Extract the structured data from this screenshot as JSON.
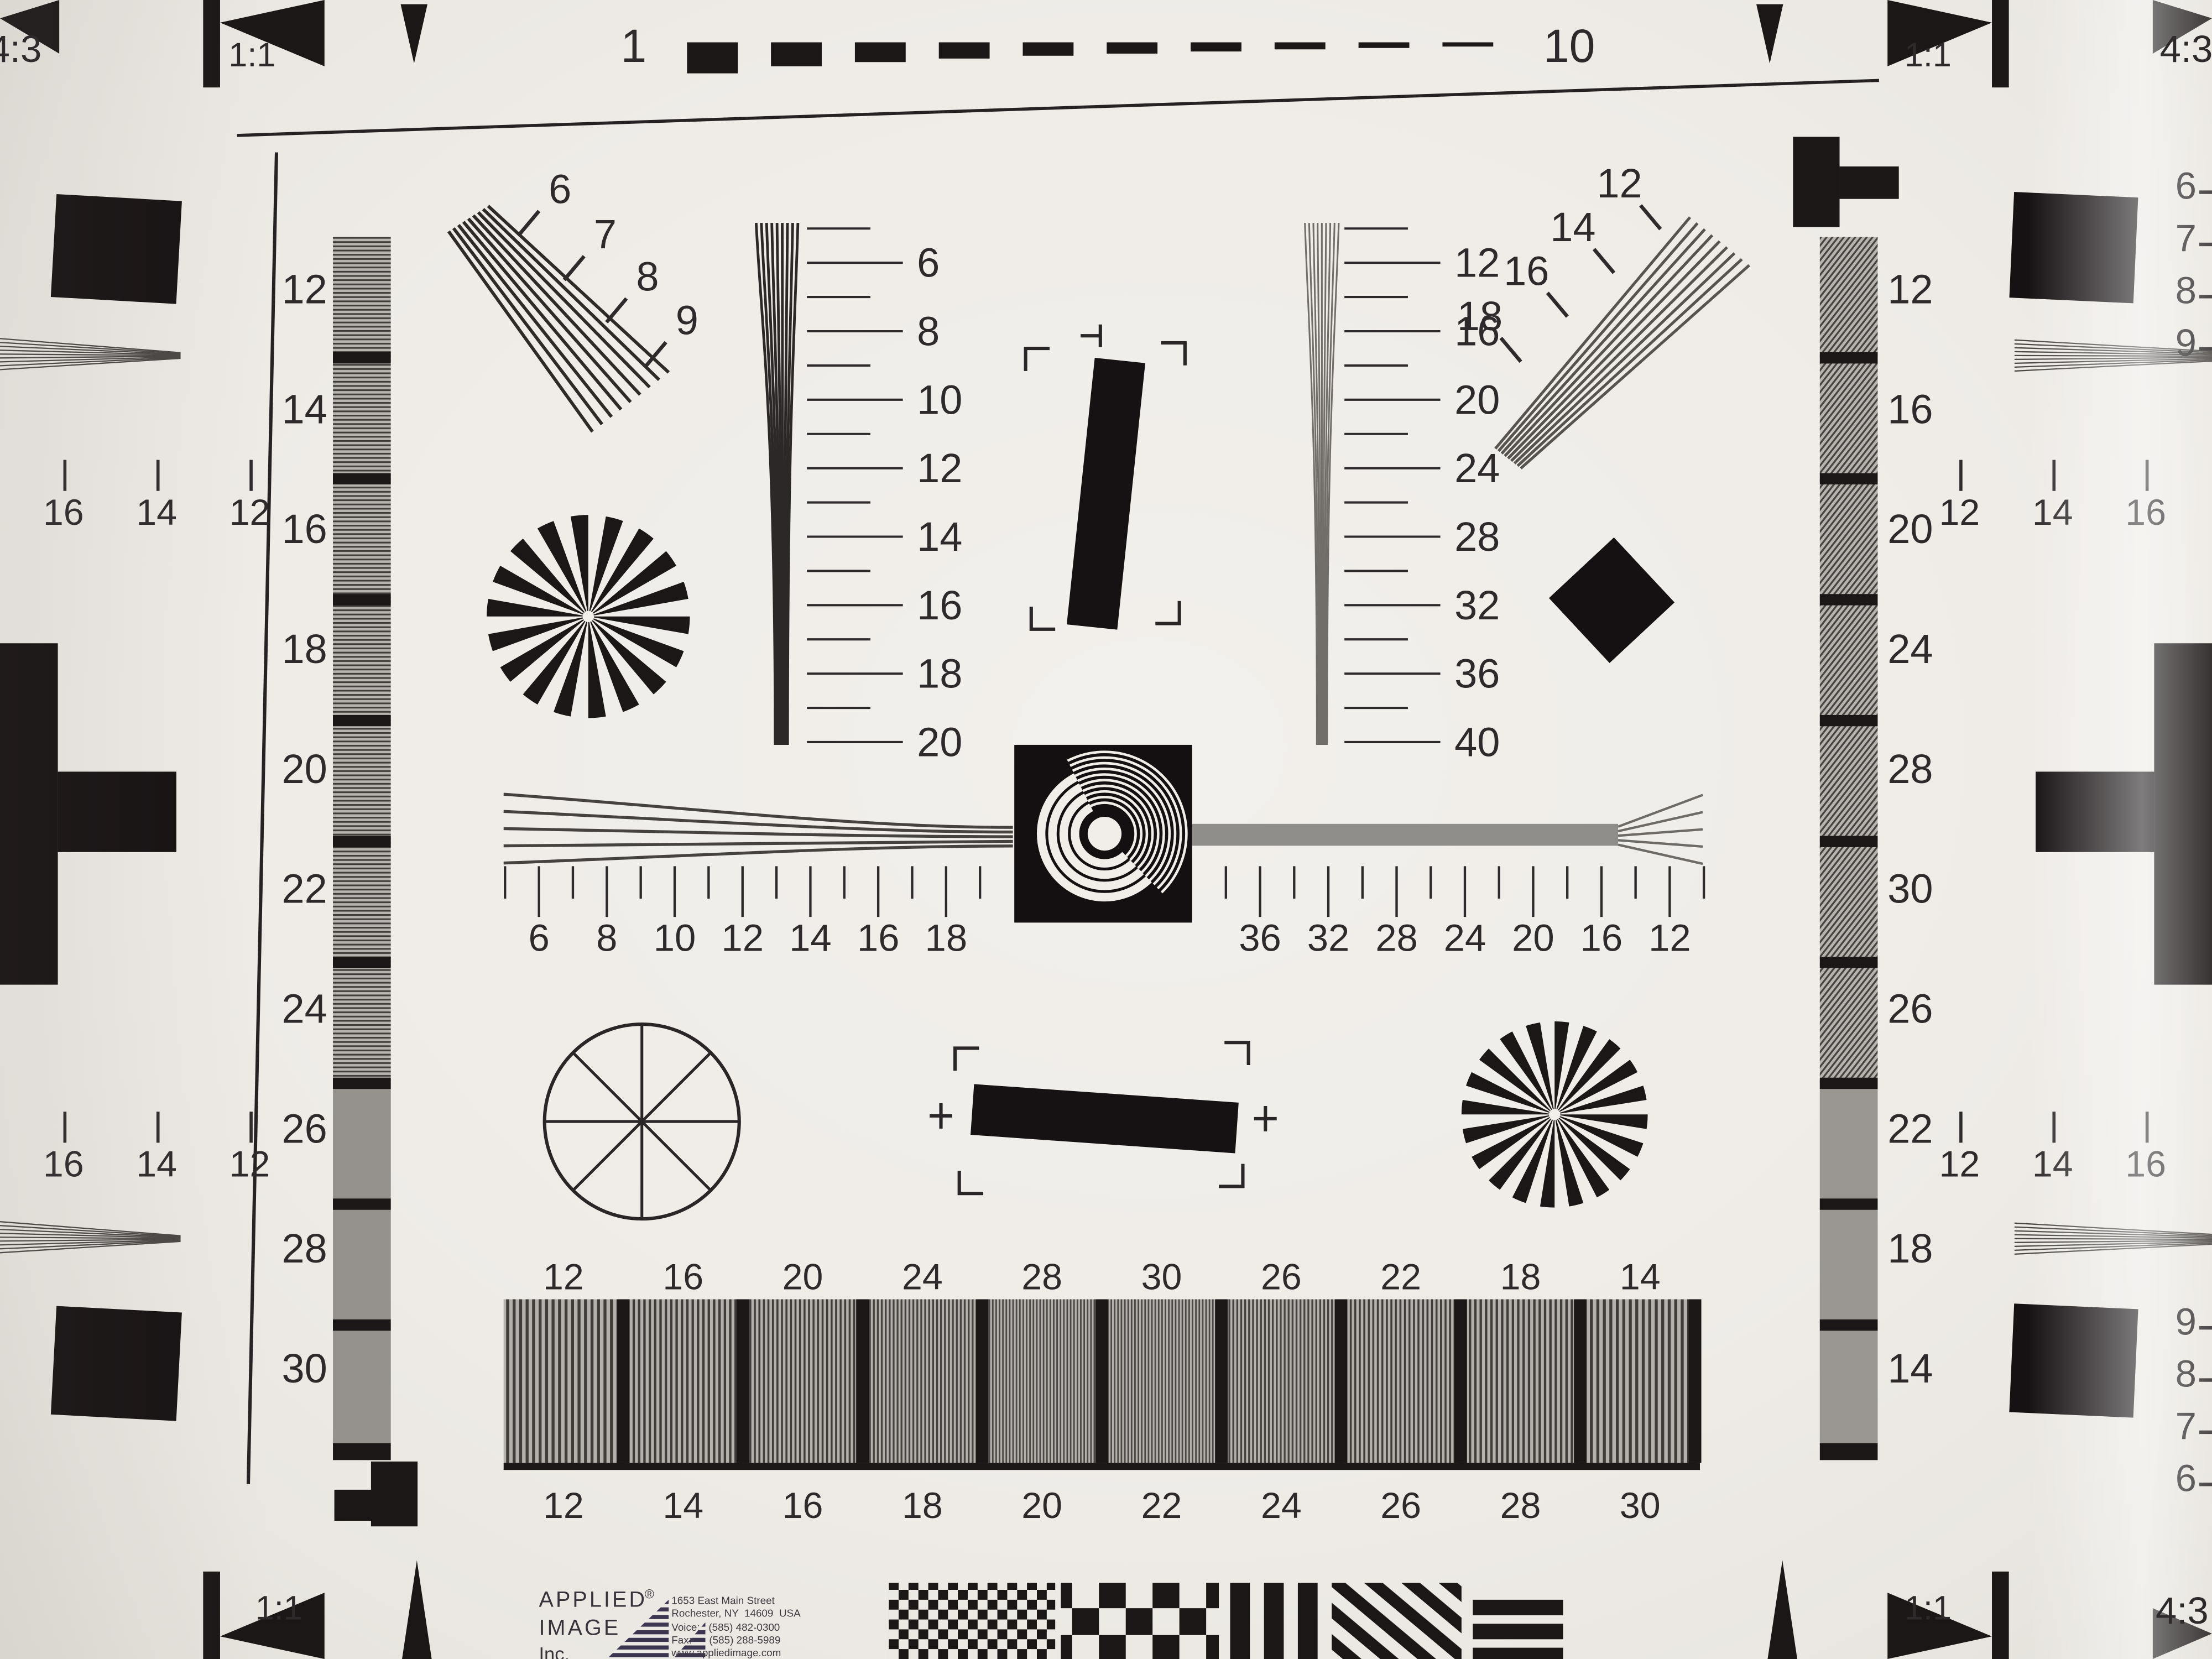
{
  "colors": {
    "paper": "#efece8",
    "ink_text": "#2e2a2c",
    "ink_black": "#1b1717",
    "strip_gray": "#95928e",
    "logo_purple": "#3b3550"
  },
  "top_ruler": {
    "start_label": "1",
    "end_label": "10",
    "dash_count": 10
  },
  "corner_markers": {
    "top_left_ratio": "4:3",
    "top_left_square": "1:1",
    "top_right_square": "1:1",
    "top_right_ratio": "4:3",
    "bottom_left_square": "1:1",
    "bottom_right_square": "1:1",
    "bottom_right_ratio": "4:3"
  },
  "left_number_column": [
    "12",
    "14",
    "16",
    "18",
    "20",
    "22",
    "24",
    "26",
    "28",
    "30"
  ],
  "right_number_column": [
    "12",
    "16",
    "20",
    "24",
    "28",
    "30",
    "26",
    "22",
    "18",
    "14"
  ],
  "upper_left_fan": {
    "labels": [
      "6",
      "7",
      "8",
      "9"
    ]
  },
  "upper_right_fan": {
    "labels": [
      "12",
      "14",
      "16",
      "18"
    ]
  },
  "center_left_wedge_scale": {
    "labels": [
      "6",
      "8",
      "10",
      "12",
      "14",
      "16",
      "18",
      "20"
    ]
  },
  "center_right_wedge_scale": {
    "labels": [
      "12",
      "16",
      "20",
      "24",
      "28",
      "32",
      "36",
      "40"
    ]
  },
  "center_ruler": {
    "left_labels": [
      "6",
      "8",
      "10",
      "12",
      "14",
      "16",
      "18"
    ],
    "right_labels": [
      "36",
      "32",
      "28",
      "24",
      "20",
      "16",
      "12"
    ]
  },
  "bottom_strip": {
    "top_labels": [
      "12",
      "16",
      "20",
      "24",
      "28",
      "30",
      "26",
      "22",
      "18",
      "14"
    ],
    "bottom_labels": [
      "12",
      "14",
      "16",
      "18",
      "20",
      "22",
      "24",
      "26",
      "28",
      "30"
    ]
  },
  "edge_scales": {
    "left_top_numbers": [
      "6",
      "7",
      "8",
      "9"
    ],
    "left_top_row": [
      "16",
      "14",
      "12"
    ],
    "left_bottom_row": [
      "16",
      "14",
      "12"
    ],
    "left_bottom_numbers": [
      "9",
      "8",
      "7",
      "6"
    ],
    "right_top_numbers": [
      "6",
      "7",
      "8",
      "9"
    ],
    "right_top_row": [
      "12",
      "14",
      "16"
    ],
    "right_bottom_row": [
      "12",
      "14",
      "16"
    ],
    "right_bottom_numbers": [
      "9",
      "8",
      "7",
      "6"
    ]
  },
  "logo": {
    "name_line1": "APPLIED",
    "name_line2": "IMAGE",
    "name_line3": "Inc.",
    "registered_mark": "®",
    "address_lines": [
      "1653 East Main Street",
      "Rochester, NY  14609  USA",
      "Voice:   (585) 482-0300",
      "Fax:      (585) 288-5989",
      "www.appliedimage.com"
    ]
  }
}
